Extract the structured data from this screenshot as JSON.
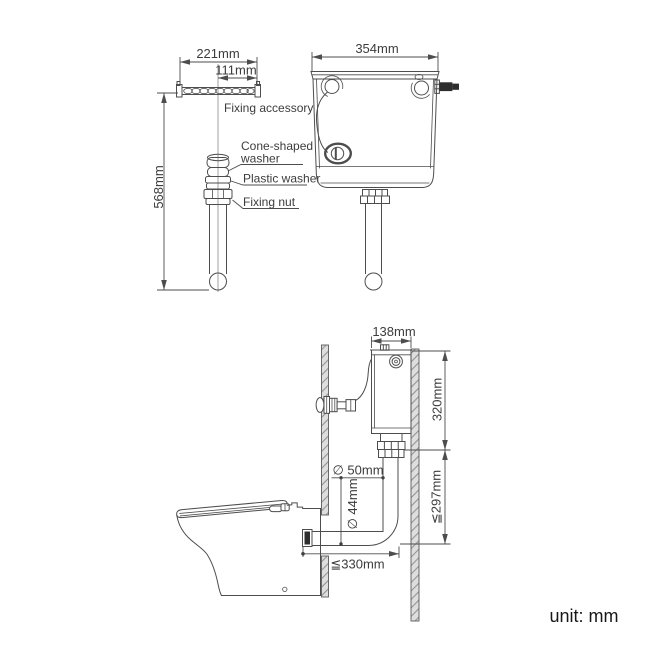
{
  "unit_note": "unit: mm",
  "accessory_view": {
    "dim_bar_width": "221mm",
    "dim_bar_center_to_end": "111mm",
    "dim_overall_height": "568mm",
    "label_fixing_accessory": "Fixing accessory",
    "label_cone_washer_line1": "Cone-shaped",
    "label_cone_washer_line2": "washer",
    "label_plastic_washer": "Plastic washer",
    "label_fixing_nut": "Fixing nut"
  },
  "cistern_front_view": {
    "dim_width": "354mm"
  },
  "installation_side_view": {
    "dim_cistern_depth": "138mm",
    "dim_cistern_height": "320mm",
    "dim_flush_pipe_outer": "∅ 50mm",
    "dim_flush_pipe_inner": "∅ 44mm",
    "dim_pipe_drop_max": "≦297mm",
    "dim_pipe_run_max": "≦330mm"
  }
}
